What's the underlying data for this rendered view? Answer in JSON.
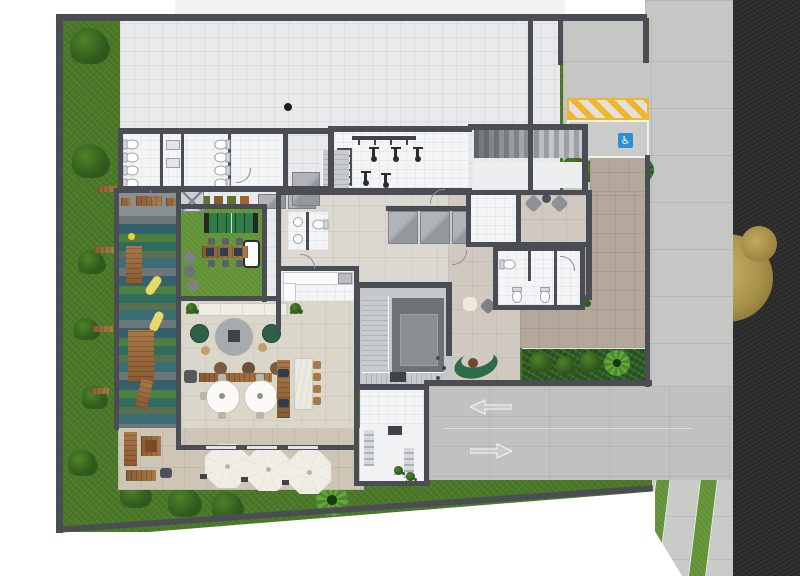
{
  "site_label": "Residential building — ground floor site plan (top view)",
  "symbols": {
    "accessible_parking": "♿"
  },
  "counts": {
    "patio_umbrellas": 3,
    "exercise_bikes": 5,
    "elevator_bank_cars": 3,
    "lounge_round_tables": 2,
    "ramp_direction_arrows": 2,
    "edge_bench_slats": 6
  },
  "regions": {
    "garden": "Perimeter garden",
    "playground": "Children's playground",
    "games_room": "Games & leisure lawn",
    "lounge": "Residents' lounge",
    "kitchen": "Shared kitchen",
    "patio": "Umbrella patio",
    "plaza": "Paved plaza",
    "restrooms": "Restrooms",
    "gym": "Fitness room",
    "stair_core": "Stair & elevator core",
    "elevator_bank": "Elevator bank",
    "entrance_hall": "Entrance hall",
    "lobby": "Lobby seating",
    "courtyard": "Inner courtyard",
    "terrace": "Paved terrace",
    "planting_bed": "Planting bed",
    "storage": "Storage room",
    "driveway": "Vehicle entrance court",
    "accessible_bay": "Accessible parking bay",
    "no_parking": "No-parking hatched zone",
    "garage_ramp": "Garage ramp",
    "sidewalk": "Sidewalk",
    "verge": "Grass verge",
    "road": "Asphalt street",
    "street_tree": "Street tree"
  },
  "palette": {
    "wall": "#4a4e54",
    "grass": "#4c7a28",
    "turf": "#649538",
    "bed": "#2c5a20",
    "bush": "#2f5a1d",
    "bush_light": "#4e8329",
    "palm": "#275a22",
    "palm_bright": "#4a8a2c",
    "tree_gold": "#a9914a",
    "plaza": "#e9eaec",
    "hall": "#dbd8d2",
    "court": "#cfc9c0",
    "terr": "#b3a89b",
    "patio": "#cdc5b6",
    "beige": "#dad6ca",
    "whiteroom": "#f4f5f6",
    "conc": "#c4c7c3",
    "side": "#c8cbc7",
    "road": "#2d2e2d",
    "ramp": "#bfc2bf",
    "stripe1": "#6d7578",
    "stripe2": "#33606b",
    "stripe3": "#4f7f41",
    "stripe4": "#2f6b5e",
    "stripe5": "#5a7050",
    "stripe6": "#3a6d74",
    "yellow": "#f0b42d",
    "blue": "#2e8fd5",
    "wood": "#8a5a33",
    "wood_light": "#a97947",
    "cream": "#f0ede4",
    "green_sofa": "#2e6b4a",
    "dkgreen_chair": "#2d5f49"
  }
}
